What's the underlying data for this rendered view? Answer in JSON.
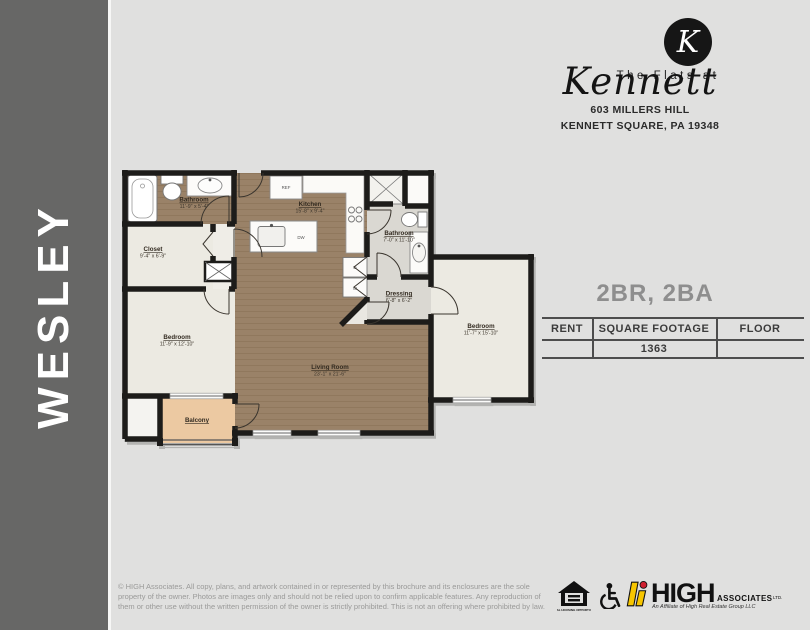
{
  "sidebar": {
    "title": "WESLEY"
  },
  "brand": {
    "monogram": "K",
    "name_line1": "The Flats at",
    "name_script": "Kennett",
    "address_line1": "603 MILLERS HILL",
    "address_line2": "KENNETT SQUARE, PA 19348"
  },
  "unit": {
    "config": "2BR, 2BA",
    "table": {
      "headers": [
        "RENT",
        "SQUARE FOOTAGE",
        "FLOOR"
      ],
      "square_footage": "1363"
    }
  },
  "floorplan": {
    "bathroom1": {
      "name": "Bathroom",
      "dims": "11'-9\" x 5'-4\""
    },
    "closet": {
      "name": "Closet",
      "dims": "9'-4\" x 6'-9\""
    },
    "kitchen": {
      "name": "Kitchen",
      "dims": "15'-8\" x 9'-4\""
    },
    "bathroom2": {
      "name": "Bathroom",
      "dims": "7'-0\" x 11'-10\""
    },
    "dressing": {
      "name": "Dressing",
      "dims": "6'-8\" x 6'-2\""
    },
    "bedroom1": {
      "name": "Bedroom",
      "dims": "11'-9\" x 12'-10\""
    },
    "bedroom2": {
      "name": "Bedroom",
      "dims": "11'-7\" x 15'-10\""
    },
    "living": {
      "name": "Living Room",
      "dims": "23'-1\" x 21'-6\""
    },
    "balcony": {
      "name": "Balcony"
    },
    "labels": {
      "ref": "REF",
      "dw": "DW",
      "dryer": "D",
      "washer": "W"
    }
  },
  "footer": {
    "legal": "© HIGH Associates. All copy, plans, and artwork contained in or represented by this brochure and its enclosures are the sole property of the owner. Photos are images only and should not be relied upon to confirm applicable features. Any reproduction of them or other use without the written permission of the owner is strictly prohibited. This is not an offering where prohibited by law.",
    "equal_housing_label": "EQUAL HOUSING OPPORTUNITY",
    "high": {
      "name": "HIGH",
      "suffix": "ASSOCIATES",
      "ltd": "LTD.",
      "tagline": "An Affiliate of High Real Estate Group LLC"
    }
  },
  "colors": {
    "page_bg": "#e0e0df",
    "sidebar_bg": "#676766",
    "floor_wood": "#9a8268",
    "floor_cream": "#eceae2",
    "floor_tile": "#dad8d2",
    "balcony": "#ecc9a2",
    "wall": "#1d1c1a",
    "high_yellow": "#f7c600",
    "high_red": "#cf2030"
  }
}
